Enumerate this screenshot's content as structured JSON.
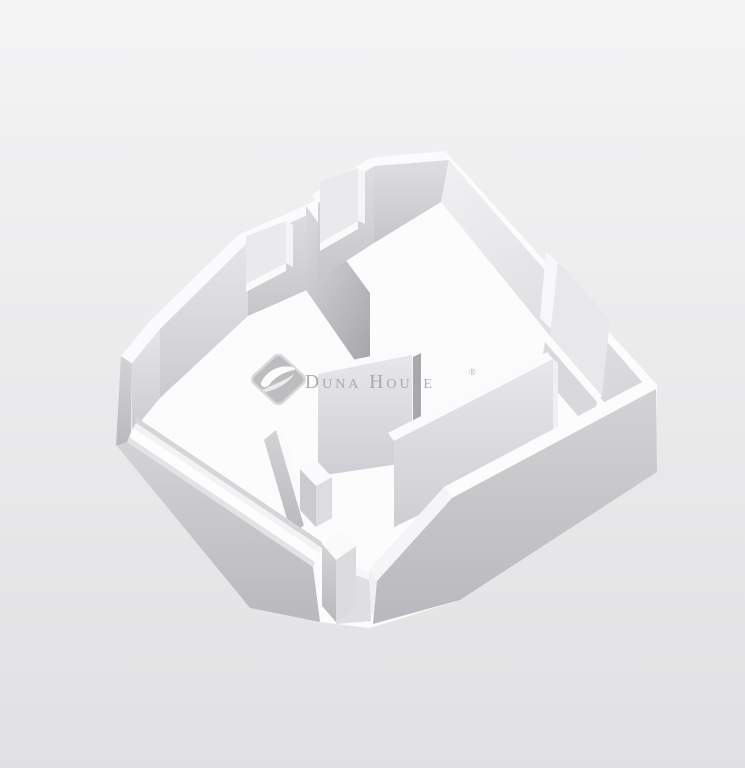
{
  "watermark": {
    "brand_name": "Duna House",
    "registered_symbol": "®",
    "text_color": "#a5a5a9",
    "logo": "leaf-swoosh-diamond",
    "logo_fill": "#b7b7ba",
    "logo_border": "#d6d6d9"
  },
  "scene": {
    "type": "3d-floorplan-render",
    "style": "isometric dollhouse cutaway with white walls on light gray background",
    "rooms_visible": 2,
    "features": [
      "chamfered corner wall with square window",
      "back wall square window",
      "tall window opening in right wall",
      "long strip window in low front-left wall",
      "front door opening with jamb block",
      "interior room divider wall with doorway",
      "hallway partition walls",
      "middle partition wall with doorway gap"
    ]
  },
  "palette": {
    "background_top": "#f4f4f5",
    "background_bottom": "#e1e1e3",
    "floor": "#fcfcfd",
    "wall_top_surface": "#fcfcfd",
    "wall_inner_light": "#f0f0f2",
    "wall_inner_mid": "#d9d9dc",
    "wall_outer_shadow": "#b9b9bd",
    "divider_shadow": "#a9a9ad",
    "opening_background": "#e8e8ea"
  }
}
